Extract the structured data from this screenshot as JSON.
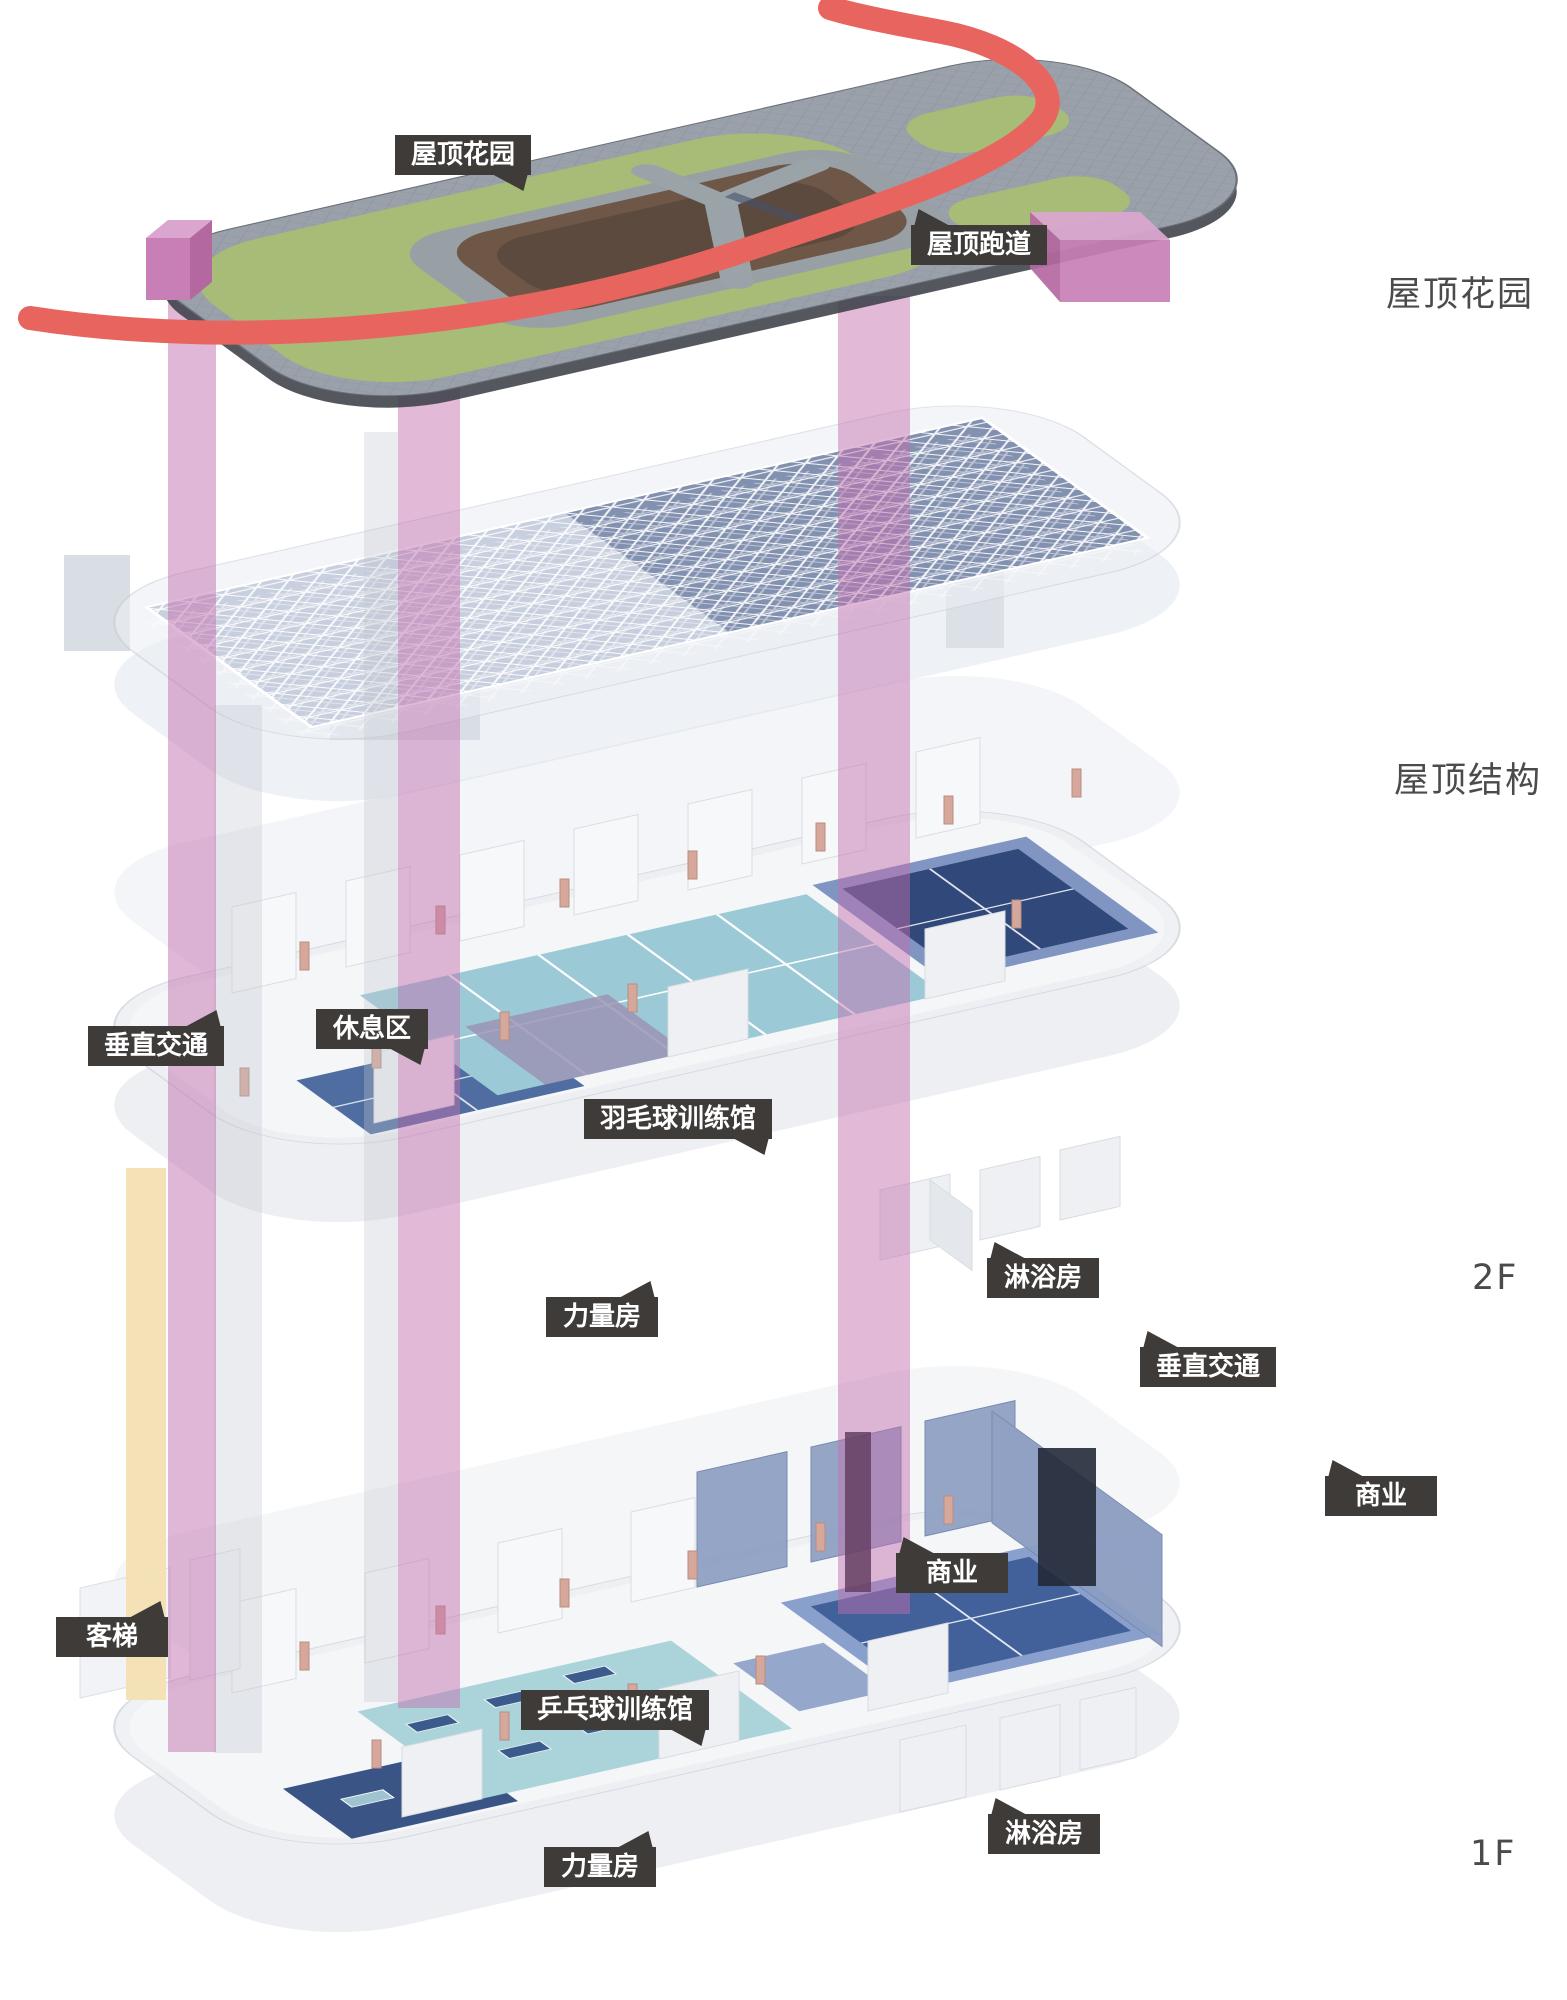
{
  "diagram": {
    "type": "exploded-axonometric-building-diagram",
    "callouts": [
      {
        "id": "roof-garden",
        "text": "屋顶花园"
      },
      {
        "id": "roof-track",
        "text": "屋顶跑道"
      },
      {
        "id": "vertical-circulation-2f",
        "text": "垂直交通"
      },
      {
        "id": "rest-area",
        "text": "休息区"
      },
      {
        "id": "badminton-hall",
        "text": "羽毛球训练馆"
      },
      {
        "id": "strength-room-2f",
        "text": "力量房"
      },
      {
        "id": "shower-room-2f",
        "text": "淋浴房"
      },
      {
        "id": "vertical-circulation-1f",
        "text": "垂直交通"
      },
      {
        "id": "commercial-mid",
        "text": "商业"
      },
      {
        "id": "commercial-right",
        "text": "商业"
      },
      {
        "id": "passenger-elevator",
        "text": "客梯"
      },
      {
        "id": "table-tennis-hall",
        "text": "乒乓球训练馆"
      },
      {
        "id": "strength-room-1f",
        "text": "力量房"
      },
      {
        "id": "shower-room-1f",
        "text": "淋浴房"
      }
    ],
    "level_annotations": [
      {
        "id": "level-roof-garden",
        "text": "屋顶花园"
      },
      {
        "id": "level-roof-structure",
        "text": "屋顶结构"
      },
      {
        "id": "level-2f",
        "text": "2F"
      },
      {
        "id": "level-1f",
        "text": "1F"
      }
    ],
    "colors": {
      "callout_bg": "#3e3b39",
      "callout_text": "#ffffff",
      "annotation_text": "#4b4b4b",
      "track_red": "#e8655f",
      "lawn_green": "#a6bc77",
      "planting_brown": "#6e5747",
      "paving_gray": "#9aa1aa",
      "shaft_pink": "#c26fae",
      "elevator_cream": "#f3e0b2",
      "court_teal": "#9bcad6",
      "court_navy": "#30487a",
      "truss_blue": "#7d8cab"
    }
  }
}
